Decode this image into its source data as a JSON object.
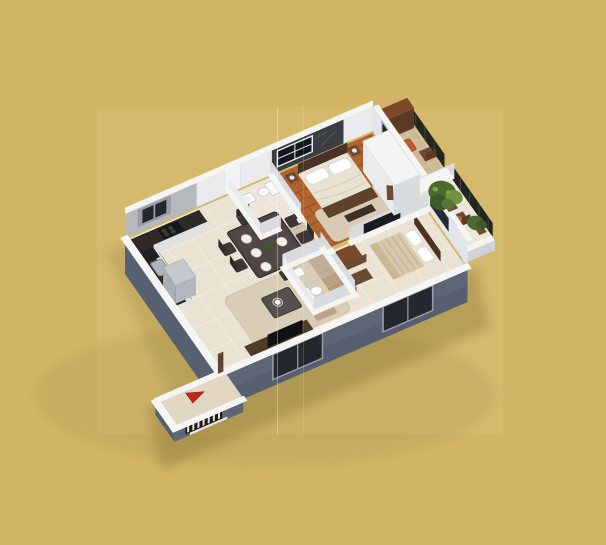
{
  "page": {
    "width": 606,
    "height": 545,
    "background": "#d2b566",
    "image_region": {
      "x": 97,
      "y": 107,
      "width": 406,
      "height": 327,
      "background": "#d5ba6e"
    },
    "fold_line_positions": [
      277.5,
      303.5
    ]
  },
  "palette": {
    "gold-page": "#d2b566",
    "gold-image": "#d5ba6e",
    "shadow": "#6d5c22",
    "wall-top": "#f5f5f3",
    "wall-int": "#e9ebec",
    "wall-int-shade": "#d9dcdf",
    "wall-kitchen": "#b5b9be",
    "wall-face-ext": "#5d6577",
    "wall-face-ext-dark": "#525a6b",
    "wall-side": "#566070",
    "accent-wall": "#3a3d42",
    "glass": "#23272e",
    "frame": "#9aa0a8",
    "floor-cream": "#eae3d3",
    "tile-line": "#f8f4ea",
    "floor-bath": "#ece6da",
    "corridor": "#cfbfa6",
    "porch-floor": "#e0d6c1",
    "wood": "#b2652f",
    "wood-line": "#8f4a22",
    "deck": "#ccb892",
    "rug": "#d9cab2",
    "rug-living": "#d8cdb6",
    "counter": "#2e2a28",
    "cabinet-face": "#dfe0e2",
    "steel": "#aeb6bc",
    "fridge": "#c5c9ce",
    "fridge-face": "#b2b7bd",
    "table-dark": "#4d4340",
    "chair": "#3b3734",
    "sofa": "#bd9f82",
    "tv-cab": "#503c2b",
    "tv": "#101114",
    "bed-cream": "#e8e2d2",
    "duvet-stripe": "#d8c9ae",
    "stripe-line": "#c4b393",
    "headboard": "#4a3326",
    "throw": "#5d4128",
    "wood-brown": "#6b4a33",
    "brown-dark": "#5d3a26",
    "brown-top": "#7c4a2b",
    "orange": "#c05a2f",
    "green": "#4c6b2f",
    "green-dark": "#3f5a28",
    "green-light": "#6d9240",
    "railing": "#22261f",
    "fixture": "#fbfbfb",
    "red": "#c4261d",
    "grill-dark": "#1d1b17",
    "grill-bar": "#e8e0c8",
    "sill": "#e8e8e8"
  },
  "scene": {
    "type": "3d-floorplan-render",
    "view": "isometric",
    "rooms": [
      "kitchen",
      "dining",
      "living",
      "bathroom",
      "bathroom",
      "master-bedroom",
      "bedroom",
      "balcony",
      "balcony",
      "entrance-porch"
    ],
    "entrance_arrow": {
      "shape": "triangle",
      "color": "#c4261d"
    }
  }
}
